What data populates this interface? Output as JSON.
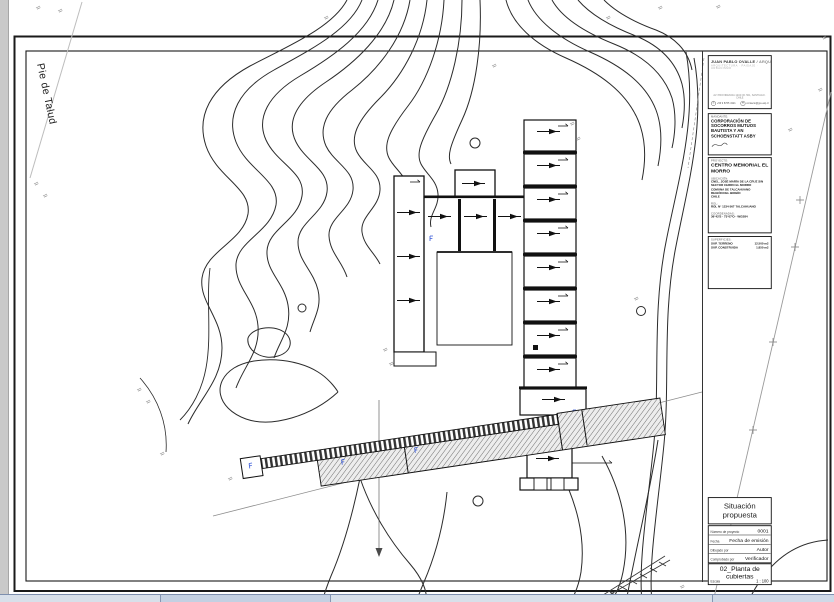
{
  "drawing": {
    "pie_de_talud": "Pie de Talud"
  },
  "titleblock": {
    "architect": {
      "name": "JUAN PABLO OVALLE",
      "separator": " / ",
      "title": "ARQUITECTO",
      "subtitle": "ARQUITECTURA · PAISAJE · URBANISMO",
      "address": "AV. PROVIDENCIA 1234 OF. 501, SANTIAGO · CHILE",
      "phone": "+56 9 8765 4321",
      "email": "contacto@jpo-arq.cl",
      "phone_icon": "✆",
      "email_icon": "✉"
    },
    "mandante": {
      "label": "MANDANTE:",
      "name": "CORPORACIÓN DE SOCORROS MUTUOS BAUTISTA Y AN SCHOENSTATT ASBY"
    },
    "proyecto": {
      "label": "PROYECTO:",
      "name": "CENTRO MEMORIAL EL MORRO",
      "ubicacion_label": "UBICACIÓN:",
      "ubicacion": [
        "CNEL. JOSÉ MARÍA DE LA CRUZ S/N",
        "SECTOR CERRO EL MORRO",
        "COMUNA DE TALCAHUANO",
        "REGIÓN DEL BIOBÍO",
        "CHILE"
      ],
      "rol_label": "ROL:",
      "rol": "ROL N° 1234-567 TALCAHUANO",
      "coordenadas_label": "COORDENADAS:",
      "coordenadas": "36°42'S · 73°07'O · WGS84"
    },
    "superficies": {
      "label": "SUPERFICIES:",
      "rows": [
        {
          "name": "SUP. TERRENO",
          "value": "12.500 m2"
        },
        {
          "name": "SUP. CONSTRUIDA",
          "value": "1.850 m2"
        }
      ]
    },
    "situacion": "Situación propuesta",
    "info_rows": [
      {
        "label": "Número de proyecto",
        "value": "0001"
      },
      {
        "label": "Fecha",
        "value": "Fecha de emisión"
      },
      {
        "label": "Dibujado por",
        "value": "Autor"
      },
      {
        "label": "Comprobado por",
        "value": "Verificador"
      }
    ],
    "sheet": {
      "number_title": "02_Planta de cubiertas",
      "escala_label": "Escala",
      "escala_value": "1 : 100"
    }
  }
}
